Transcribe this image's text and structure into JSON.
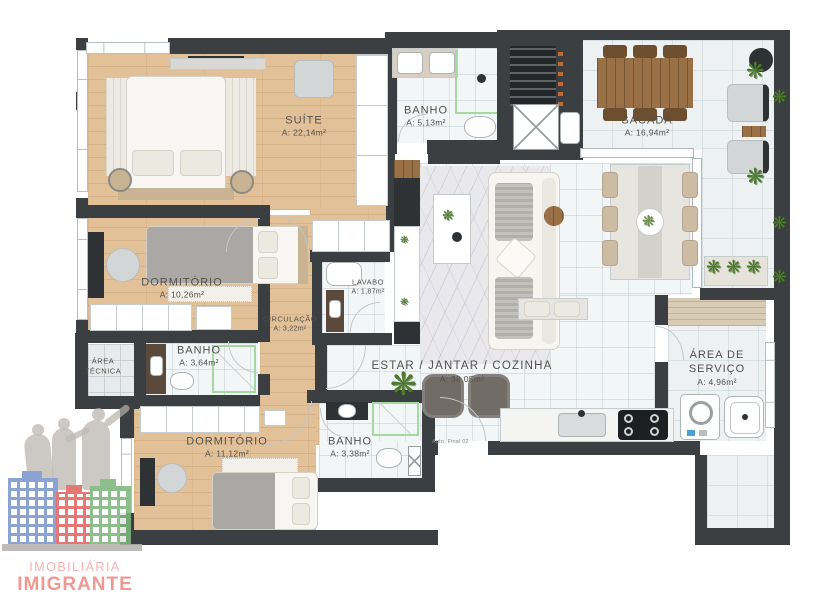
{
  "plan": {
    "unit_note": "Apto. Final 02",
    "rooms": {
      "suite": {
        "name": "SUÍTE",
        "area": "A: 22,14m²"
      },
      "banho_suite": {
        "name": "BANHO",
        "area": "A: 5,13m²"
      },
      "sacada": {
        "name": "SACADA",
        "area": "A: 16,94m²"
      },
      "dormitorio_1": {
        "name": "DORMITÓRIO",
        "area": "A: 10,26m²"
      },
      "lavabo": {
        "name": "LAVABO",
        "area": "A: 1,87m²"
      },
      "circulacao": {
        "name": "CIRCULAÇÃO",
        "area": "A: 3,22m²"
      },
      "area_tecnica": {
        "name": "ÁREA TÉCNICA",
        "area": ""
      },
      "banho_social": {
        "name": "BANHO",
        "area": "A: 3,64m²"
      },
      "estar_jantar_cozinha": {
        "name": "ESTAR / JANTAR / COZINHA",
        "area": "A: 38,05m²"
      },
      "dormitorio_2": {
        "name": "DORMITÓRIO",
        "area": "A: 11,12m²"
      },
      "banho_2": {
        "name": "BANHO",
        "area": "A: 3,38m²"
      },
      "area_servico": {
        "name": "ÁREA DE SERVIÇO",
        "area": "A: 4,96m²"
      }
    }
  },
  "logo": {
    "line1": "IMOBILIÁRIA",
    "line2": "IMIGRANTE"
  },
  "icons": {
    "plant": "❋"
  },
  "colors": {
    "wall": "#3b3f41",
    "wood_floor": "#e2c098",
    "tile_floor": "#f3f6f7",
    "shower_accent": "#a6d8a2",
    "skewer_orange": "#c06a32",
    "plant_green": "#4d7a2e",
    "logo_blue": "#7b97cd",
    "logo_red": "#e26562",
    "logo_green": "#7eb77d",
    "logo_text_pink": "#ee8a85"
  }
}
